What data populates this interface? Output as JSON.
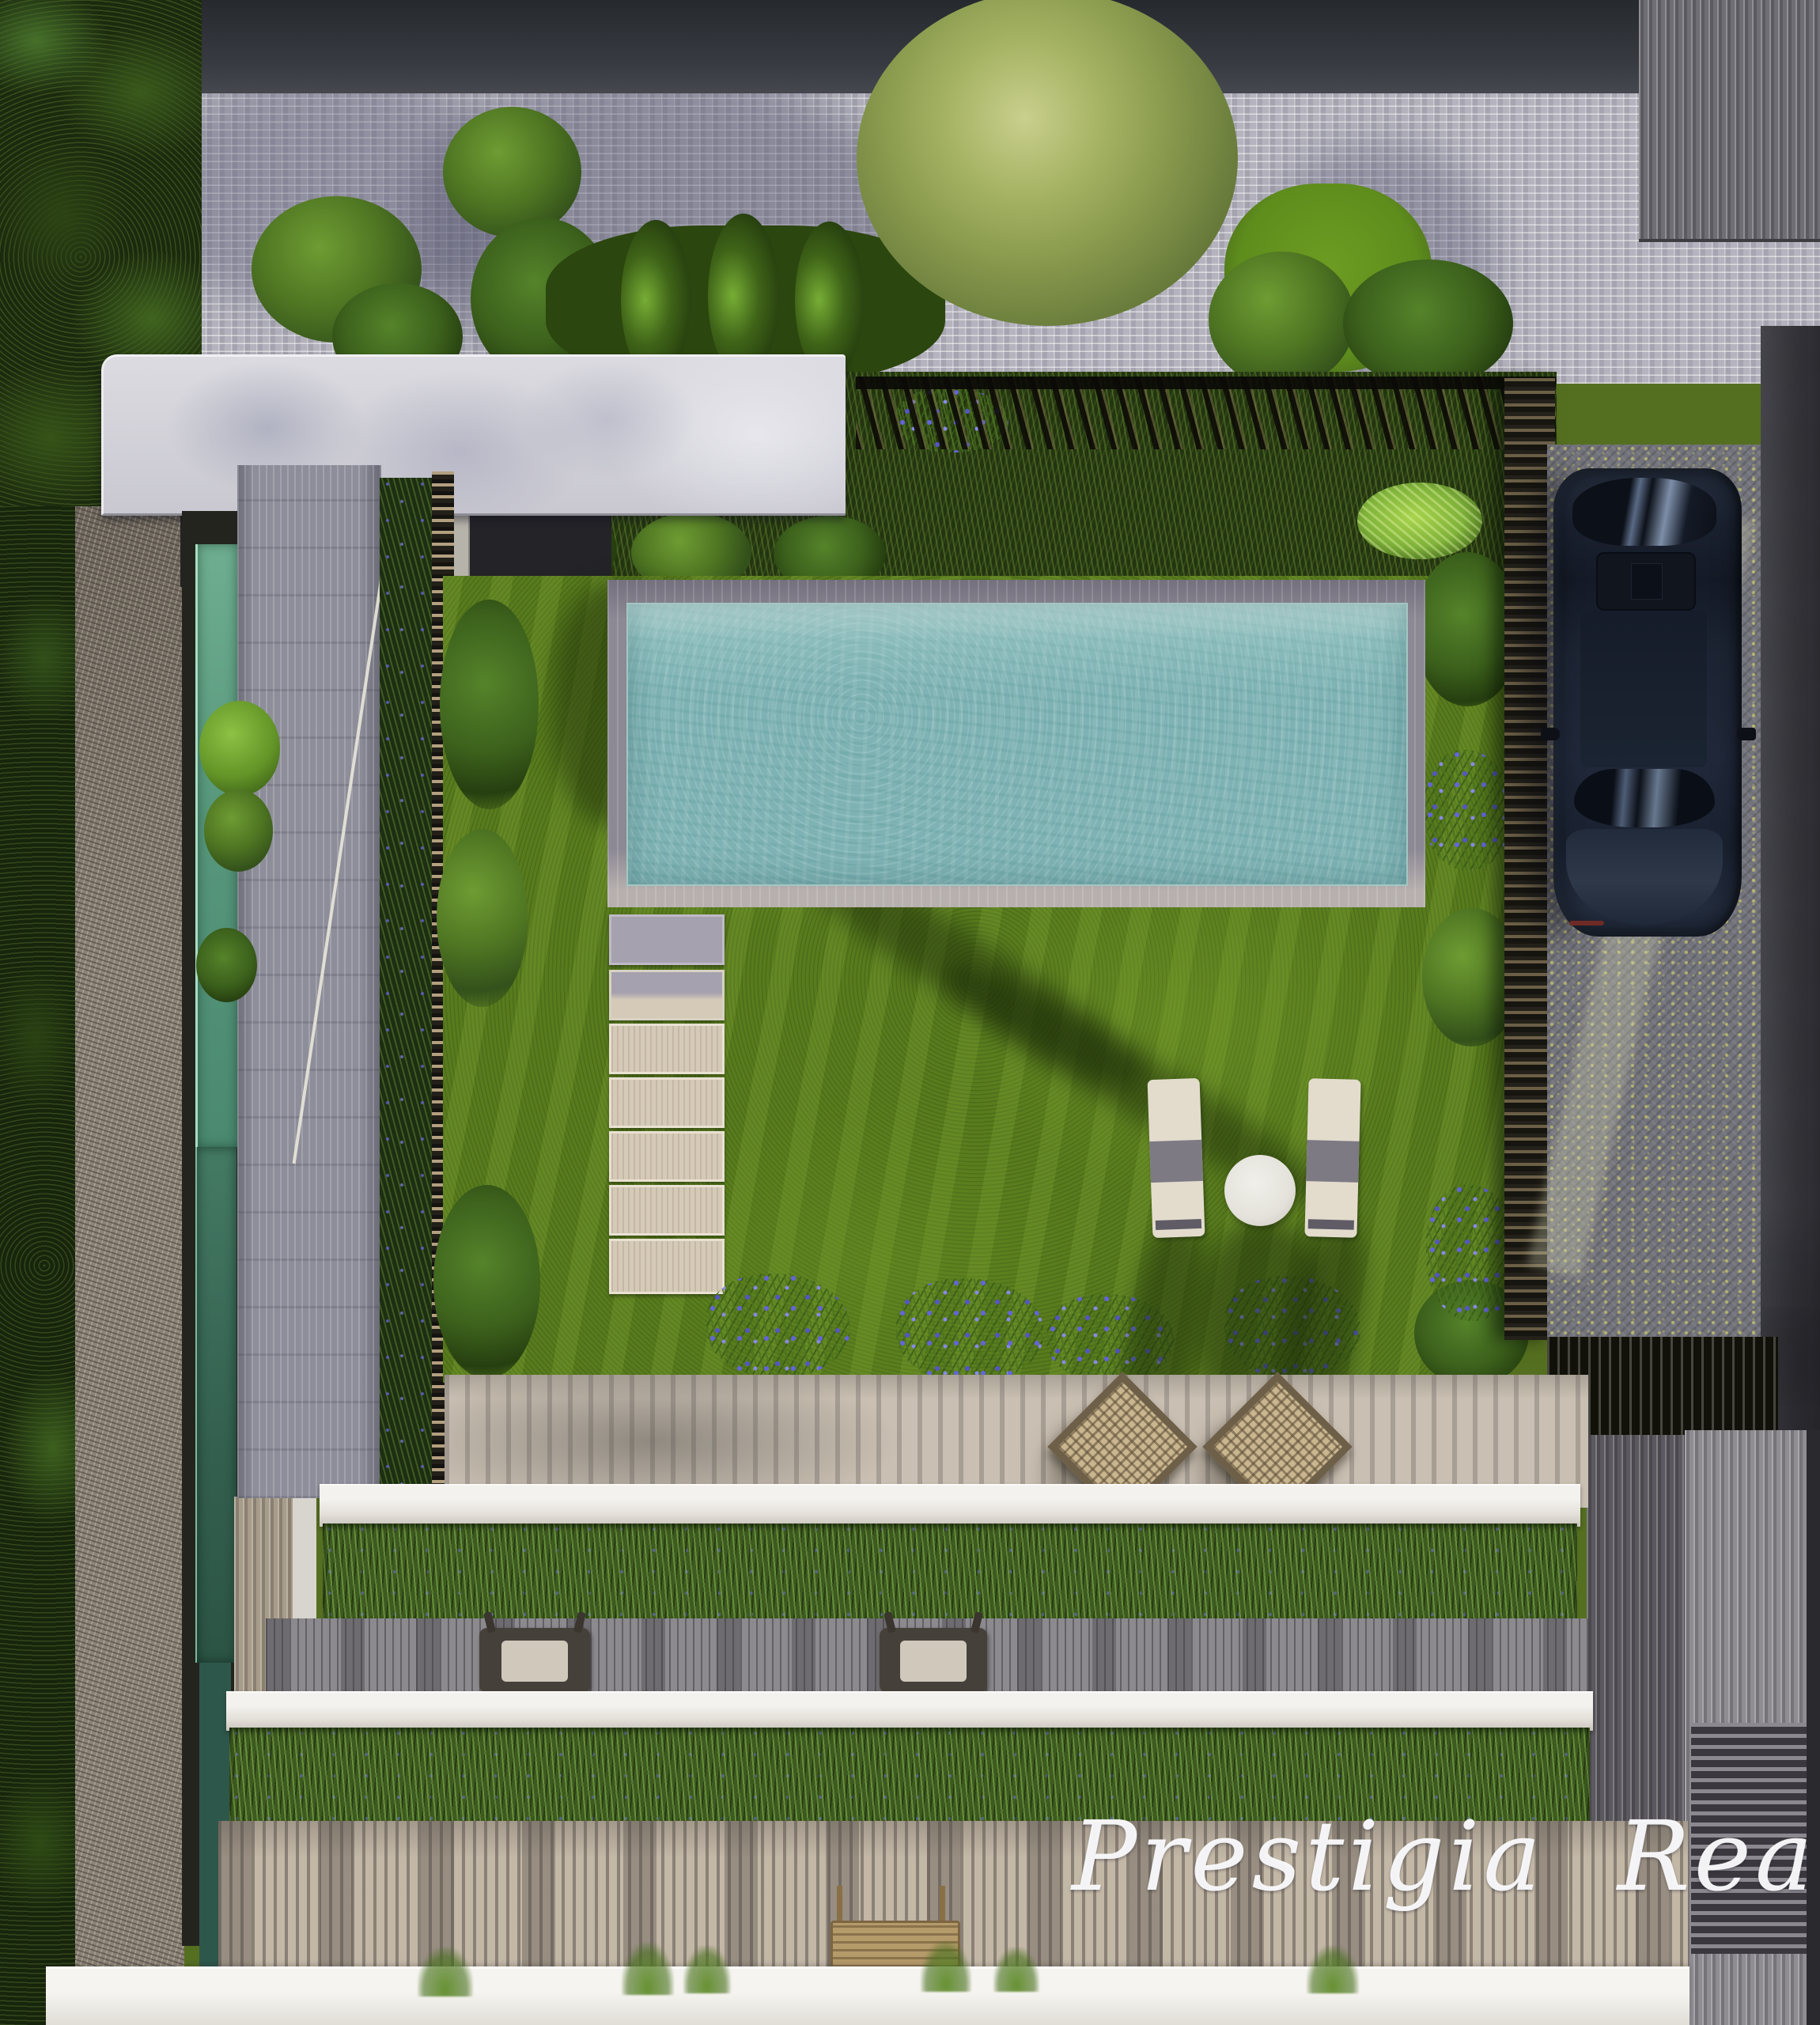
{
  "scene": {
    "description": "Aerial top-down 3D render of a modern villa garden with swimming pool, lawn, stepping stones, parked car and green-roof terraces",
    "counts": {
      "stepping_stones": 7,
      "sun_loungers": 2,
      "round_tables": 1,
      "wicker_chairs": 2,
      "deck_chairs": 2,
      "benches": 1,
      "cars": 1,
      "cypress_shrubs": 3
    }
  },
  "watermark": {
    "text": "Prestigia Realty"
  },
  "palette": {
    "lawn": "#587b1d",
    "pool_water": "#7fb2b4",
    "pool_deck": "#8c8894",
    "cobblestone": "#b5b4be",
    "canopy": "#d3d1d8",
    "stepping_stone": "#d5cab7",
    "skylight_glass": "#579a80",
    "driveway": "#73737b",
    "car_body": "#1d2433",
    "fence_slats": "#211f19",
    "terrace": "#c9bfb2",
    "parapet_white": "#eae8e3",
    "planter_green": "#3d5a20",
    "deck_wood": "#c3b7a6",
    "tree_dark": "#1b2a0e",
    "flower_blue": "#6464dc"
  }
}
